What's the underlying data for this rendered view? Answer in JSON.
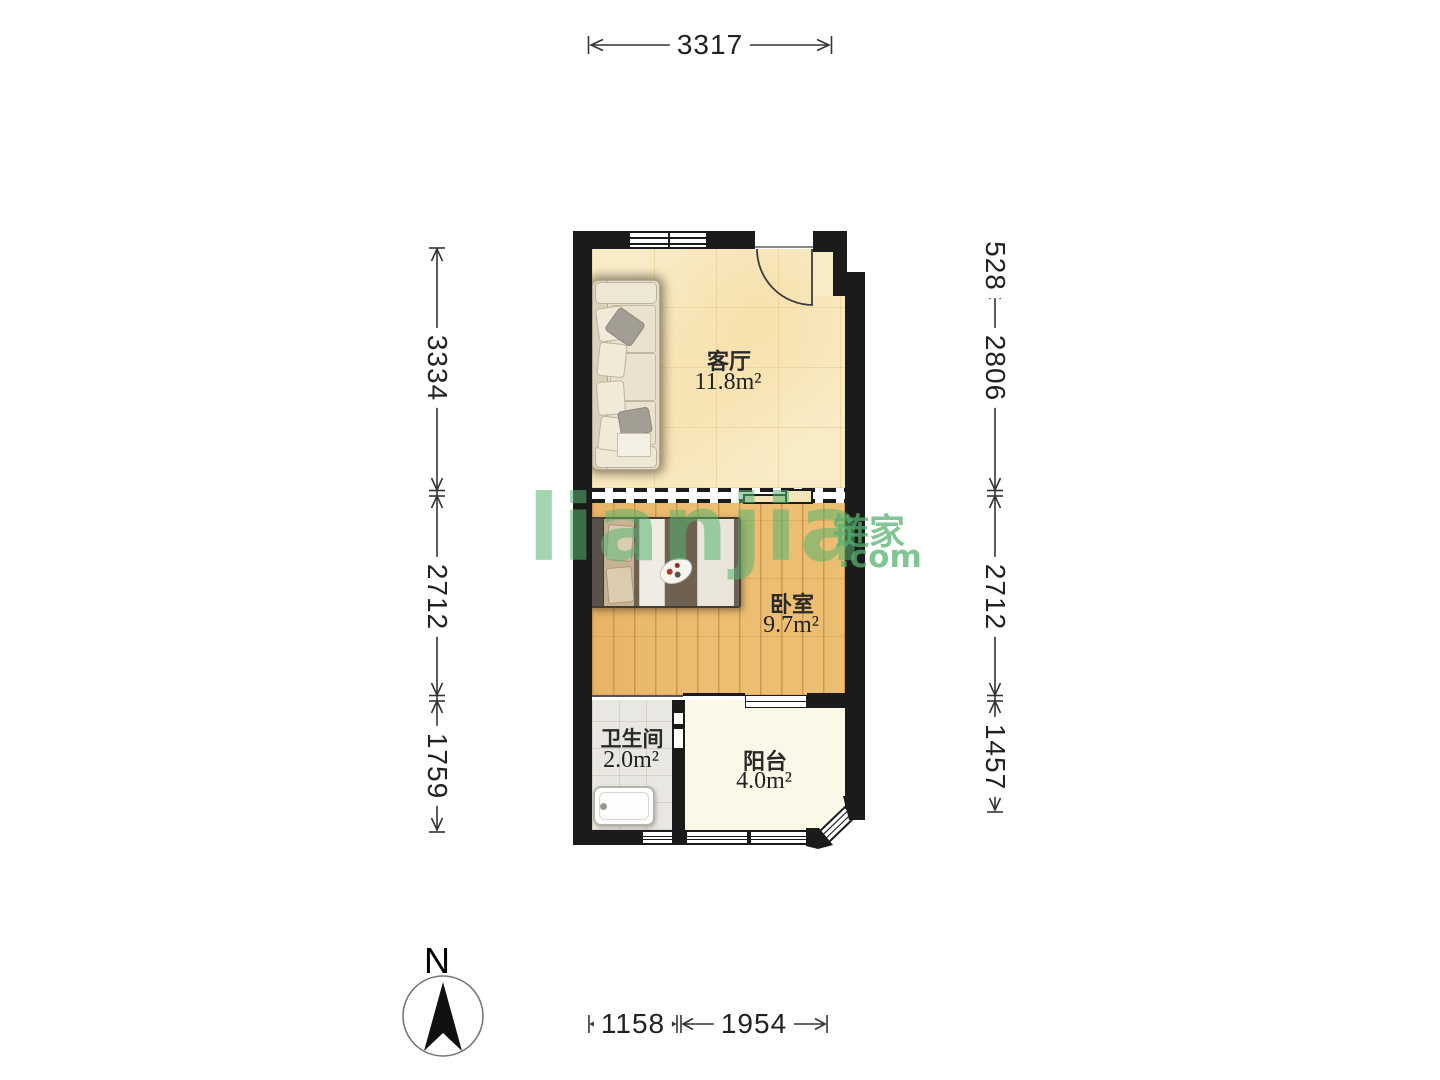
{
  "compass": {
    "north_label": "N"
  },
  "watermark": {
    "brand": "lianjia",
    "brand_cn": "链家",
    "domain": ".com"
  },
  "rooms": {
    "living": {
      "name": "客厅",
      "area": "11.8m²"
    },
    "bedroom": {
      "name": "卧室",
      "area": "9.7m²"
    },
    "bathroom": {
      "name": "卫生间",
      "area": "2.0m²"
    },
    "balcony": {
      "name": "阳台",
      "area": "4.0m²"
    }
  },
  "dimensions": {
    "top": [
      "3317"
    ],
    "left": [
      "3334",
      "2712",
      "1759"
    ],
    "right": [
      "528",
      "2806",
      "2712",
      "1457"
    ],
    "bottom": [
      "1158",
      "1954"
    ]
  },
  "colors": {
    "wall": "#1b1b1b",
    "living_floor": "#f8ecc6",
    "bedroom_floor": "#ecbe72",
    "bathroom_floor": "#e9e7e2",
    "balcony_floor": "#fbf8e8",
    "watermark_green": "#58b270",
    "dimension_text": "#222222"
  }
}
